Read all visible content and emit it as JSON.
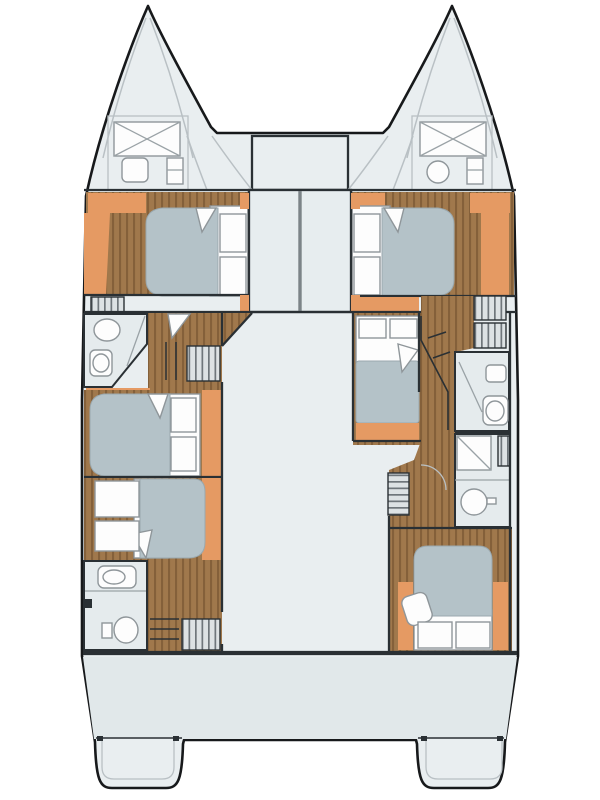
{
  "diagram": {
    "title": "Catamaran yacht deck floor plan, bow up",
    "kind": "boat-floor-plan",
    "orientation": "bow-up",
    "rooms": [
      "port-bow-locker",
      "starboard-bow-locker",
      "foredeck",
      "anchor-locker",
      "forward-port-cabin",
      "forward-starboard-cabin",
      "port-mid-bathroom",
      "port-mid-cabin",
      "port-aft-cabin",
      "port-aft-bathroom",
      "salon",
      "starboard-mid-cabin",
      "starboard-mid-bathroom",
      "starboard-aft-bathroom",
      "starboard-aft-cabin",
      "cockpit",
      "port-transom-platform",
      "starboard-transom-platform"
    ],
    "fixtures": [
      "double-bed",
      "pillows",
      "wardrobe",
      "toilet",
      "sink",
      "shower",
      "stairs",
      "hatch"
    ],
    "colors": {
      "page_background": "#ffffff",
      "hull_fill": "#e9eef0",
      "cockpit_fill": "#e1e8ea",
      "bathroom_fill": "#e5ebed",
      "panel_fill": "#e7edef",
      "outline": "#17191b",
      "wall": "#2a3034",
      "divider": "#7c8488",
      "wood_floor": "#a0784c",
      "wood_stripe": "#84603a",
      "orange_trim": "#e59a63",
      "mattress": "#b4c2c8",
      "mattress_edge": "#9aa8ae",
      "furniture_white": "#fdfdfd",
      "furniture_stroke": "#8f969a",
      "stair_fill": "#dde2e4",
      "stair_stripe": "#6f767b",
      "deck_line": "#b9c0c4",
      "glass_line": "#9aa2a6"
    }
  }
}
